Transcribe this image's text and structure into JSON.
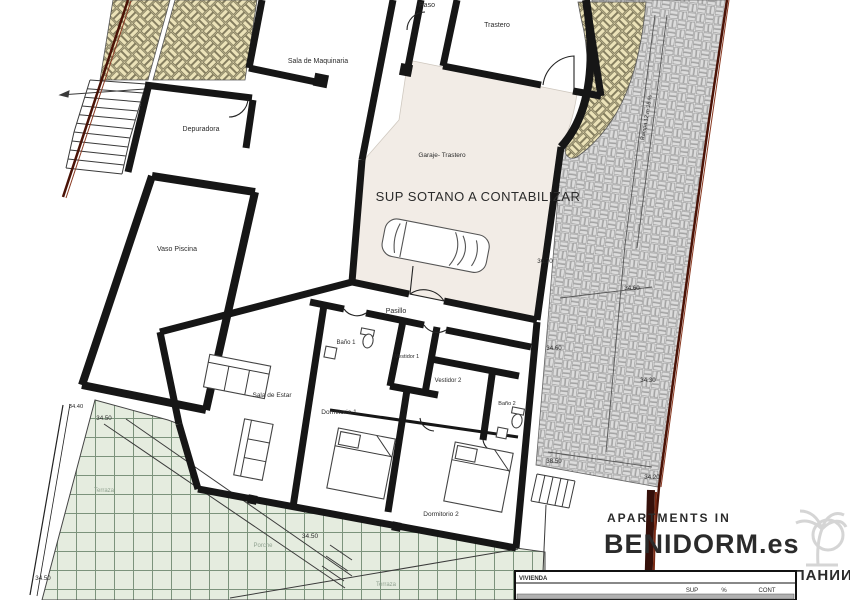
{
  "plan": {
    "room_labels": {
      "paso": "Paso",
      "trastero": "Trastero",
      "sala_maquinaria": "Sala de Maquinaria",
      "depuradora": "Depuradora",
      "vaso_piscina": "Vaso Piscina",
      "garaje_trastero": "Garaje- Trastero",
      "pasillo": "Pasillo",
      "bano_1": "Baño 1",
      "vestidor_1": "Vestidor 1",
      "vestidor_2": "Vestidor 2",
      "bano_2": "Baño 2",
      "sala_de_estar": "Sala de Estar",
      "dormitorio_1": "Dormitorio 1",
      "dormitorio_2": "Dormitorio 2",
      "terraza_upper": "Terraza",
      "terraza_lower": "Terraza",
      "porche": "Porche"
    },
    "annotations": {
      "sup_sotano": "SUP SOTANO A CONTABILIZAR",
      "rampa": "Rampa 12 m 15 %"
    },
    "dimensions": {
      "d_36_70": "36.70",
      "d_34_60_a": "34.60",
      "d_34_60_b": "34.60",
      "d_34_30": "34.30",
      "d_38_50": "38.50",
      "d_34_20": "34.20",
      "d_34_40": "34.40",
      "d_34_50_a": "34.50",
      "d_34_50_b": "34.50",
      "d_34_50_c": "34.50"
    },
    "colors": {
      "boundary": "#4a1206",
      "boundary_light": "#8a3a22",
      "wall": "#161616",
      "beige_hatch": "#ebe2b8",
      "grey_brick": "#dcdcdc",
      "green_terrace": "#e5ecdf",
      "garage_fill": "#f2ece6",
      "watermark": "#d9d9d9"
    }
  },
  "watermark": {
    "line1": "APARTMENTS IN",
    "line2": "BENIDORM.es",
    "line3": "НЕДВИЖИМОСТЬ В ИСПАНИИ"
  },
  "summary_table": {
    "title": "VIVIENDA",
    "columns": [
      "SUP",
      "%",
      "CONT"
    ]
  }
}
